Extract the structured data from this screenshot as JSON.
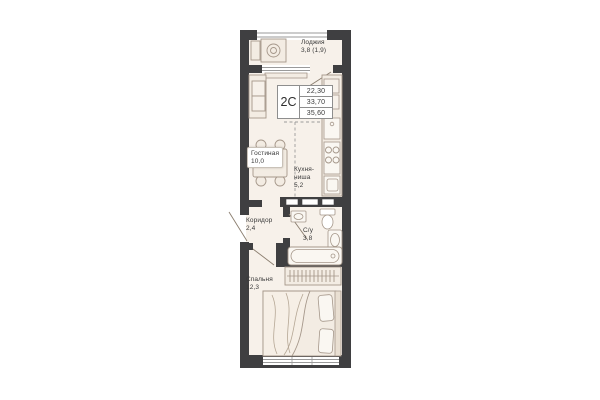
{
  "unit": {
    "type": "2С",
    "area_values": [
      "22,30",
      "33,70",
      "35,60"
    ]
  },
  "rooms": {
    "loggia": {
      "name": "Лоджия",
      "area": "3,8 (1,9)"
    },
    "living": {
      "name": "Гостиная",
      "area": "10,0"
    },
    "kitchen": {
      "name_line1": "Кухня-",
      "name_line2": "ниша",
      "area": "5,2"
    },
    "corridor": {
      "name": "Коридор",
      "area": "2,4"
    },
    "bathroom": {
      "name": "С/у",
      "area": "3,8"
    },
    "bedroom": {
      "name": "Спальня",
      "area": "12,3"
    }
  },
  "colors": {
    "wall": "#3f3f41",
    "floor": "#f7f1ea",
    "furniture_stroke": "#a5978a",
    "furniture_fill": "#f3ece3",
    "text": "#3a3a3a"
  }
}
